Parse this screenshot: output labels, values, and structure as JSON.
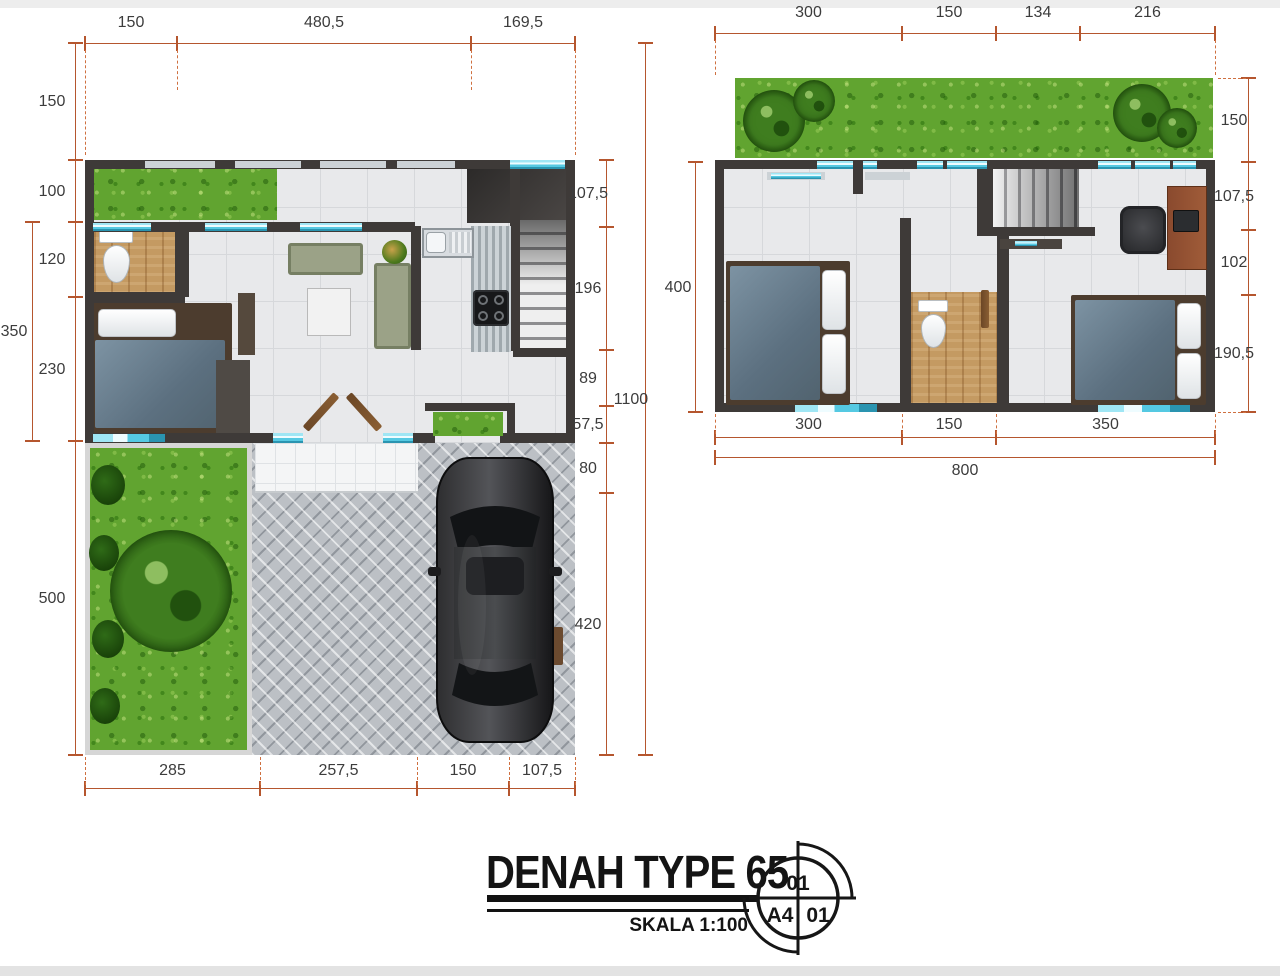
{
  "document": {
    "type_label": "DENAH TYPE 65",
    "scale_label": "SKALA 1:100",
    "stamp": {
      "top": "01",
      "bottom_left": "A4",
      "bottom_right": "01"
    }
  },
  "ground_floor_plan": {
    "dims_top": [
      "150",
      "480,5",
      "169,5"
    ],
    "dims_bottom": [
      "285",
      "257,5",
      "150",
      "107,5"
    ],
    "dims_left": [
      "150",
      "100",
      "120",
      "230",
      "500"
    ],
    "dim_left_outer": "350",
    "dims_right": [
      "107,5",
      "196",
      "89",
      "57,5",
      "80",
      "420"
    ],
    "dim_right_outer": "1100"
  },
  "upper_floor_plan": {
    "dims_top": [
      "300",
      "150",
      "134",
      "216"
    ],
    "dims_bottom": [
      "300",
      "150",
      "350"
    ],
    "dim_bottom_outer": "800",
    "dim_left": "400",
    "dims_right": [
      "150",
      "107,5",
      "102",
      "190,5"
    ]
  },
  "colors": {
    "dimension_line": "#b5562e",
    "wall": "#3e3a38",
    "window": "#7fdbf0",
    "grass": "#61a430",
    "wood_floor": "#c49a62",
    "driveway": "#bcc0c5"
  }
}
